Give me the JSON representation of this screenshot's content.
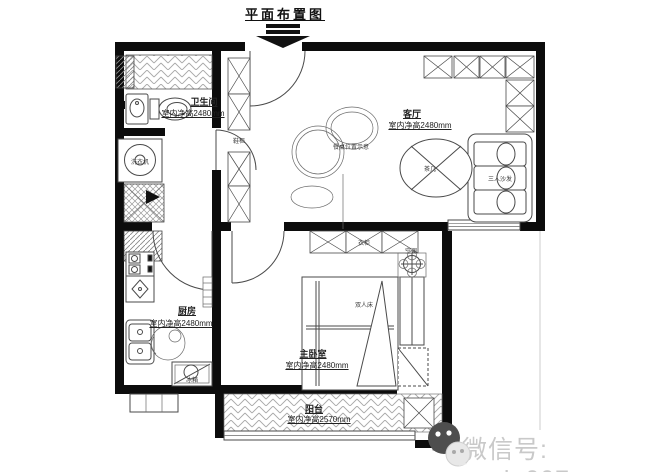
{
  "title": "平面布置图",
  "rooms": {
    "bathroom": {
      "name": "卫生间",
      "note": "室内净高2480mm"
    },
    "living_room": {
      "name": "客厅",
      "note": "室内净高2480mm"
    },
    "kitchen": {
      "name": "厨房",
      "note": "室内净高2480mm"
    },
    "master_bedroom": {
      "name": "主卧室",
      "note": "室内净高2480mm"
    },
    "balcony": {
      "name": "阳台",
      "note": "室内净高2570mm"
    }
  },
  "annotations": {
    "washing_machine": "洗衣机",
    "shoe_cabinet": "鞋柜",
    "wardrobe": "衣柜",
    "dining_table_note": "餐桌位置示意",
    "tea_table": "茶几",
    "sofa": "三人沙发",
    "air_conditioner": "空调",
    "double_bed": "双人床",
    "fridge": "冰箱"
  },
  "watermark": {
    "label": "微信号: gzvip007"
  },
  "colors": {
    "wall": "#0c0c0c",
    "line": "#4a4a4a",
    "hatch": "#a8a8a8",
    "text": "#222222",
    "watermark": "#c9c9c9"
  }
}
